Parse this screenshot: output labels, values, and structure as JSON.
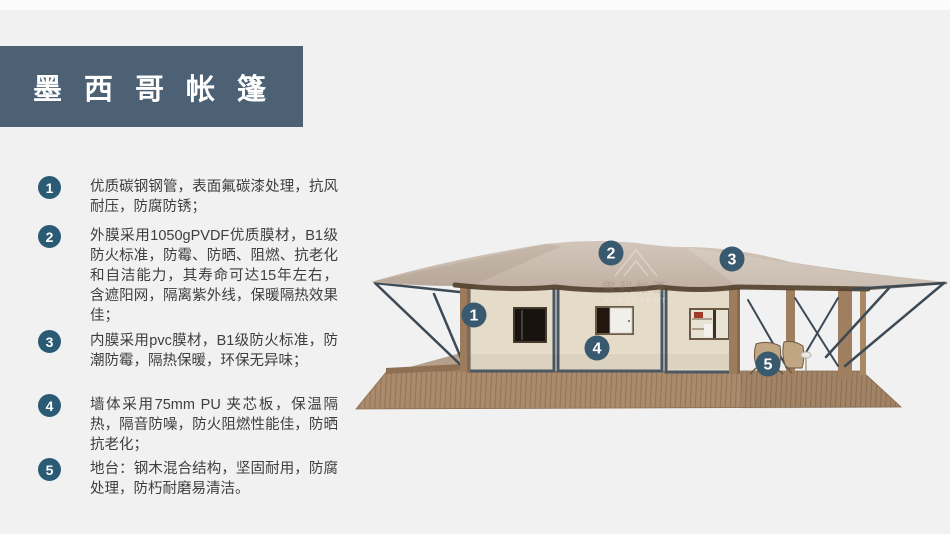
{
  "title": {
    "text": "墨西哥帐篷"
  },
  "features": [
    {
      "num": "1",
      "text": "优质碳钢钢管，表面氟碳漆处理，抗风耐压，防腐防锈；"
    },
    {
      "num": "2",
      "text": "外膜采用1050gPVDF优质膜材，B1级防火标准，防霉、防晒、阻燃、抗老化和自洁能力，其寿命可达15年左右，含遮阳网，隔离紫外线，保暖隔热效果佳；"
    },
    {
      "num": "3",
      "text": "内膜采用pvc膜材，B1级防火标准，防潮防霉，隔热保暖，环保无异味；"
    },
    {
      "num": "4",
      "text": "墙体采用75mm PU 夹芯板，保温隔热，隔音防噪，防火阻燃性能佳，防晒抗老化；"
    },
    {
      "num": "5",
      "text": "地台：钢木混合结构，坚固耐用，防腐处理，防朽耐磨易清洁。"
    }
  ],
  "watermark": {
    "cn": "雪利帐篷",
    "en": "XUELI TENT"
  },
  "colors": {
    "page_background": "#f1f1f1",
    "banner": "#4d6175",
    "badge": "#2b5a74",
    "callout_marker": "#39596f",
    "canopy": "#c9bab0",
    "wall": "#e4dbc8",
    "frame": "#4b5761",
    "wood": "#a07f60",
    "text": "#3e3e3e"
  }
}
